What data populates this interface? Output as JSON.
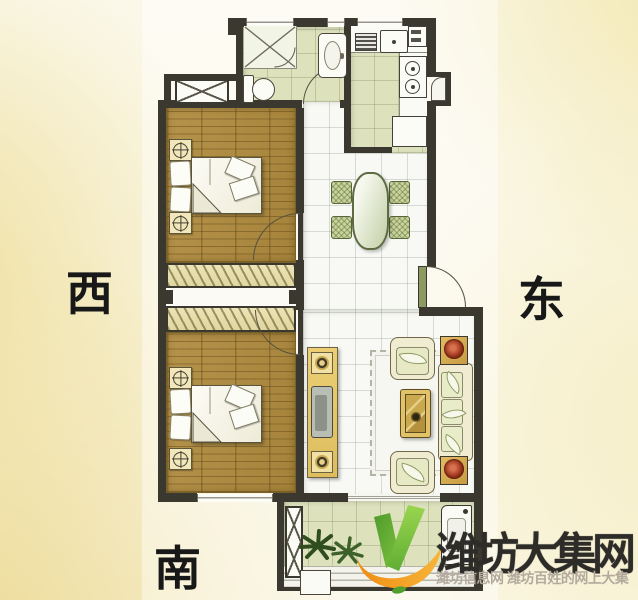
{
  "compass": {
    "west": "西",
    "east": "东",
    "south": "南"
  },
  "watermark": {
    "title": "潍坊大集网",
    "subtitle": "潍坊信息网 潍坊百姓的网上大集"
  },
  "palette": {
    "wall": "#3b382f",
    "wood_floor": "#ac8a42",
    "green_floor": "#dde2bd",
    "tile_floor": "#f8f9f4",
    "paper_yellow": "#eedf9d",
    "entry_door_green": "#8c9a62",
    "logo_green": "#6ab33e",
    "logo_orange": "#f49b18",
    "flower_red": "#97321a",
    "watermark_text": "#2e2c28",
    "watermark_subtext": "#b3aa9d"
  },
  "icons": {
    "logo": "checkmark-leaf-logo",
    "plants": "potted-plant",
    "doors": "swing-door-arc"
  }
}
